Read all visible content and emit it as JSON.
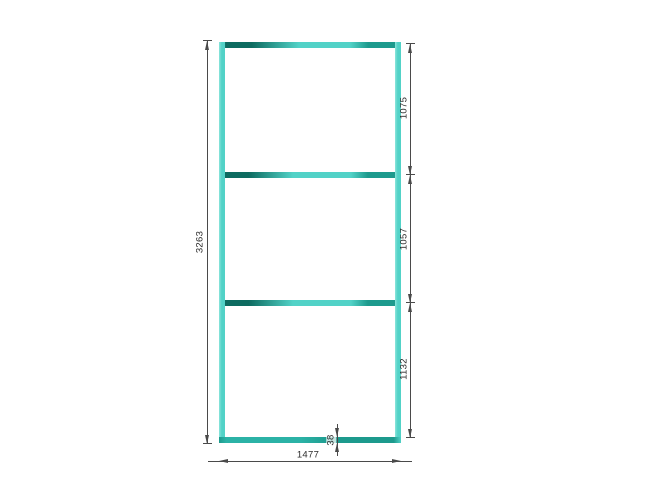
{
  "drawing": {
    "type": "frame-elevation-technical-drawing",
    "dimensions": {
      "overall_height": "3263",
      "overall_width": "1477",
      "top_segment_height": "1075",
      "middle_segment_height": "1057",
      "bottom_segment_height": "1132",
      "rail_thickness": "38"
    },
    "colors": {
      "frame_light": "#52d2c7",
      "frame_lighter": "#8ce5dc",
      "frame_mid": "#2bb2a6",
      "frame_medium_dark": "#1d9a8d",
      "frame_dark": "#0d6b60",
      "dim_line": "#4a4a4a",
      "dim_text": "#2b2b2b",
      "background": "#ffffff"
    }
  }
}
